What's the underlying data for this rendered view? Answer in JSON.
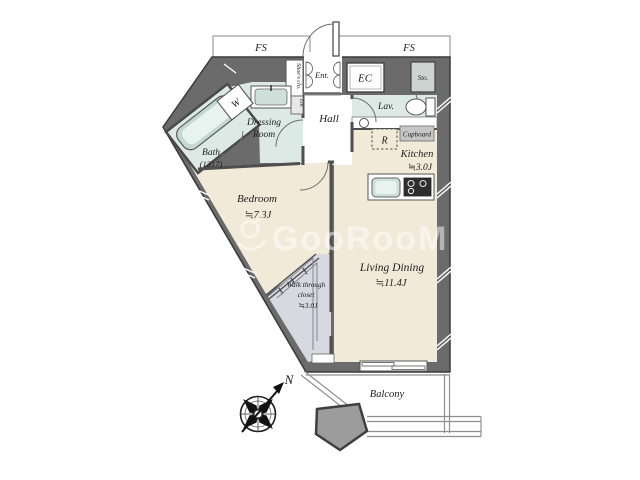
{
  "plan": {
    "watermark": {
      "text": "GooRooM"
    },
    "compass": {
      "north": "N"
    },
    "shafts": {
      "fs_left": "FS",
      "fs_right": "FS"
    },
    "rooms": {
      "entrance": {
        "name": "Ent."
      },
      "hall": {
        "name": "Hall"
      },
      "lavatory": {
        "name": "Lav."
      },
      "dressing_room": {
        "line1": "Dressing",
        "line2": "Room"
      },
      "bath": {
        "name": "Bath",
        "size": "(1317)"
      },
      "kitchen": {
        "name": "Kitchen",
        "area": "≒3.0J"
      },
      "bedroom": {
        "name": "Bedroom",
        "area": "≒7.3J"
      },
      "living_dining": {
        "name": "Living Dining",
        "area": "≒11.4J"
      },
      "walk_through_closet": {
        "line1": "Walk through",
        "line2": "closet",
        "area": "≒3.0J"
      },
      "balcony": {
        "name": "Balcony"
      }
    },
    "fixtures": {
      "entrance_closet": "EC",
      "storage": "Sto.",
      "shoes_closet": "Shoe's clo.",
      "linen": "Lin.",
      "washer": "W",
      "refrigerator": "R",
      "cupboard": "Cupboard"
    },
    "colors": {
      "wall": "#6b6b6b",
      "room_beige": "#f1ead8",
      "wet_teal": "#dde9e5",
      "closet_gray": "#d8d8e0",
      "tub": "#c3d9d2",
      "watermark": "#ffffff"
    }
  }
}
